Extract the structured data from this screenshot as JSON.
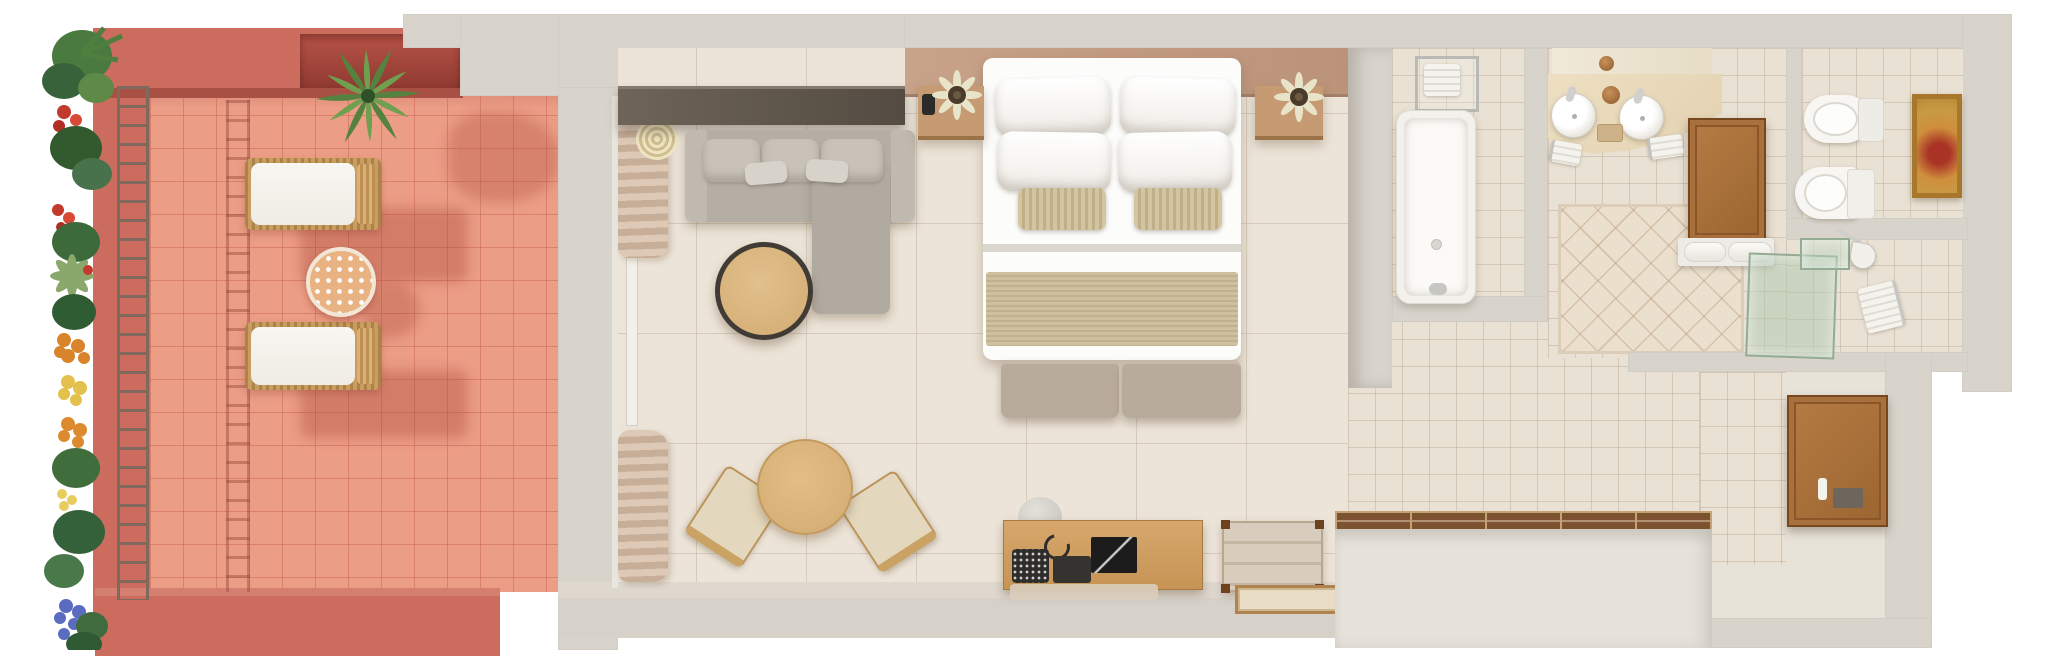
{
  "image": {
    "kind": "3d-floorplan-top-view",
    "subject": "Hotel suite floor plan with private terrace",
    "visible_text": []
  },
  "rooms": [
    {
      "name": "terrace",
      "floor": "salmon-tile",
      "items": [
        "flower-border",
        "trellis",
        "palm-plant",
        "sun-lounger-1",
        "sun-lounger-2",
        "mosaic-side-table"
      ]
    },
    {
      "name": "bedroom-living",
      "floor": "beige-stone-tile",
      "items": [
        "curtains",
        "sectional-sofa",
        "round-coffee-table",
        "king-bed",
        "pillows",
        "nightstand-left",
        "nightstand-right",
        "bedside-plant-left",
        "bedside-plant-right",
        "foot-bench",
        "dining-table",
        "dining-chair-left",
        "dining-chair-right",
        "media-desk",
        "telephone",
        "tablet",
        "tv-panel",
        "luggage-rack",
        "bench-tray"
      ]
    },
    {
      "name": "bathroom",
      "floor": "small-beige-tile",
      "items": [
        "bathtub",
        "towel-rack",
        "double-vanity",
        "vessel-sink-left",
        "vessel-sink-right",
        "mirror",
        "storage-cabinet",
        "towel-shelf",
        "diamond-tile-rug"
      ]
    },
    {
      "name": "toilet-room",
      "items": [
        "bidet",
        "toilet",
        "wall-art"
      ]
    },
    {
      "name": "shower-room",
      "items": [
        "glass-door",
        "glass-panel",
        "shower-head",
        "towel-rail"
      ]
    },
    {
      "name": "hallway-entry",
      "items": [
        "built-in-wardrobe",
        "console-cabinet"
      ]
    }
  ],
  "palette": {
    "background": "#ffffff",
    "exterior_wall": "#d8d4cc",
    "terrace_wall": "#cb6c5f",
    "terrace_wall_shadow": "#a85043",
    "terrace_floor": "#ec9d86",
    "bedroom_floor": "#ece4d8",
    "bath_floor": "#e9e1d3",
    "headboard_wall": "#c29c84",
    "ledge_brown": "#60564b",
    "sofa_gray": "#b4aea4",
    "wood_light": "#d9b47e",
    "wood_mid": "#cf9e62",
    "wood_dark": "#7d5231",
    "cabinet_wood": "#a8703c",
    "bed_white": "#fcfcfb",
    "linen_stripe": "#c9ba98",
    "bench_taupe": "#b9ab9b",
    "glass_green": "#aec8b0",
    "chrome": "#c9c9c7",
    "art_gold": "#a9772c",
    "plant_green": "#4c7a40",
    "flower_red": "#c23a2c",
    "flower_orange": "#dd8a2e",
    "flower_yellow": "#e3c14c",
    "flower_blue": "#5a6cc0"
  }
}
